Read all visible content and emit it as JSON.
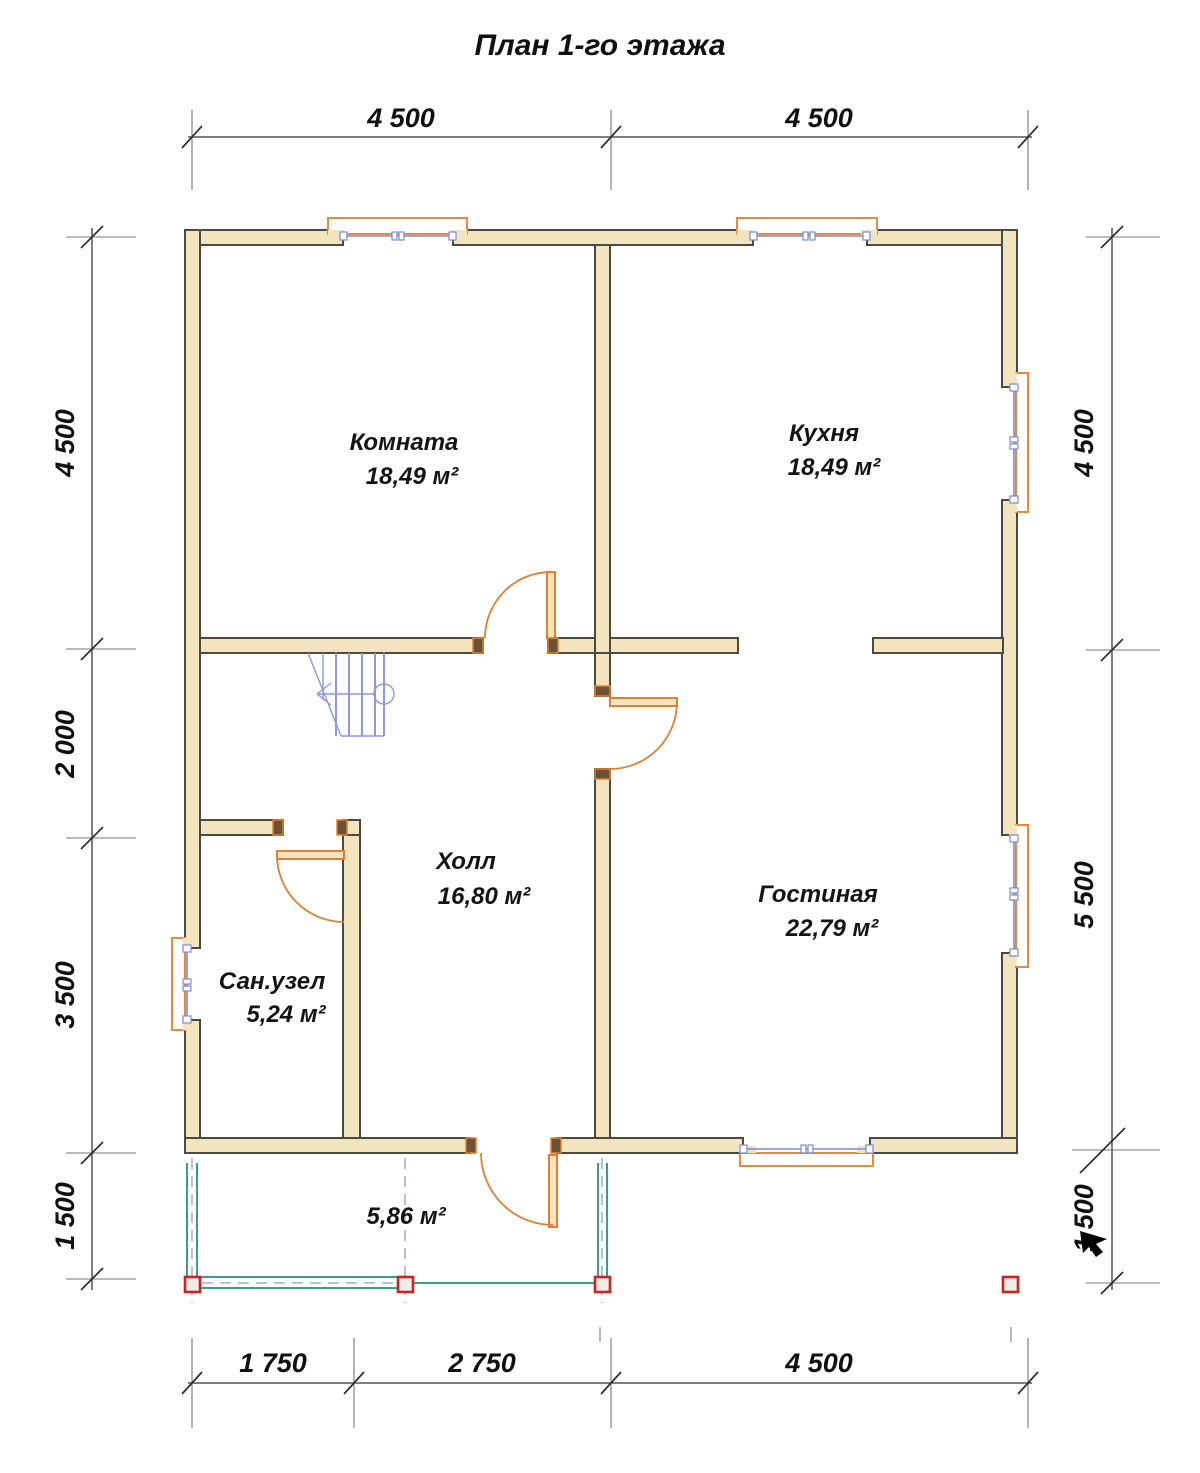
{
  "title": "План 1-го этажа",
  "colors": {
    "wall-fill": "#f2e4bf",
    "wall-stroke": "#4a4a42",
    "window-frame": "#e78a3c",
    "glazing": "#7b8ad2",
    "door": "#df8031",
    "stairs": "#8f97dd",
    "porch": "#3d9d8b",
    "column-stroke": "#c9241f",
    "column-fill": "#f0ede8"
  },
  "dims": {
    "top": [
      "4 500",
      "4 500"
    ],
    "bottom": [
      "1 750",
      "2 750",
      "4 500"
    ],
    "left": [
      "4 500",
      "2 000",
      "3 500",
      "1 500"
    ],
    "right": [
      "4 500",
      "5 500",
      "1 500"
    ]
  },
  "rooms": {
    "komnata": {
      "name": "Комната",
      "area": "18,49 м²"
    },
    "kuhnya": {
      "name": "Кухня",
      "area": "18,49 м²"
    },
    "holl": {
      "name": "Холл",
      "area": "16,80 м²"
    },
    "gostinaya": {
      "name": "Гостиная",
      "area": "22,79 м²"
    },
    "sanuzel": {
      "name": "Сан.узел",
      "area": "5,24 м²"
    },
    "terrace": {
      "area": "5,86 м²"
    }
  }
}
